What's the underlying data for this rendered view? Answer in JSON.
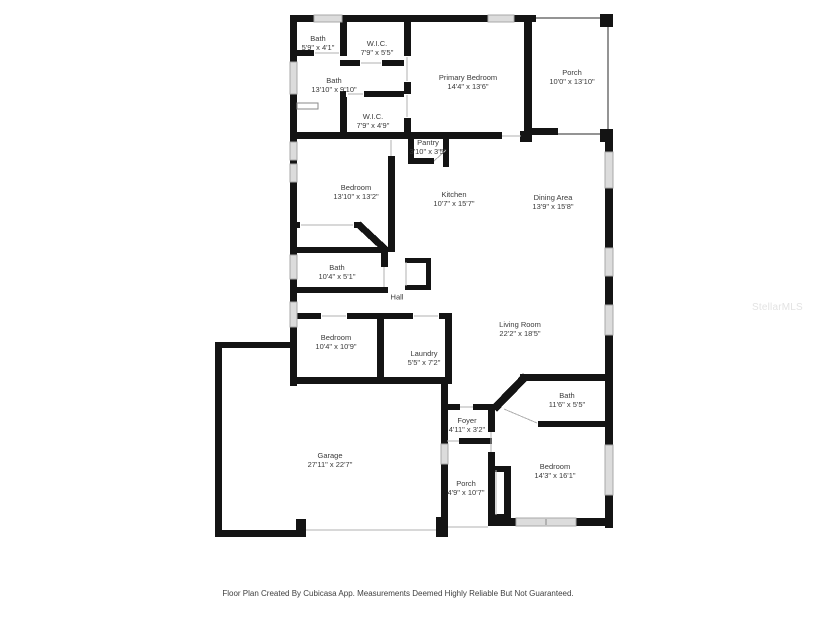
{
  "watermark": "StellarMLS",
  "footer": "Floor Plan Created By Cubicasa App. Measurements Deemed Highly Reliable But Not Guaranteed.",
  "rooms": [
    {
      "id": "bath-1",
      "name": "Bath",
      "dims": "5'9\" x 4'1\""
    },
    {
      "id": "wic-1",
      "name": "W.I.C.",
      "dims": "7'9\" x 5'5\""
    },
    {
      "id": "bath-2",
      "name": "Bath",
      "dims": "13'10\" x 9'10\""
    },
    {
      "id": "primary-bedroom",
      "name": "Primary Bedroom",
      "dims": "14'4\" x 13'6\""
    },
    {
      "id": "porch-top",
      "name": "Porch",
      "dims": "10'0\" x 13'10\""
    },
    {
      "id": "wic-2",
      "name": "W.I.C.",
      "dims": "7'9\" x 4'9\""
    },
    {
      "id": "pantry",
      "name": "Pantry",
      "dims": "3'10\" x 3'5\""
    },
    {
      "id": "bedroom-1",
      "name": "Bedroom",
      "dims": "13'10\" x 13'2\""
    },
    {
      "id": "kitchen",
      "name": "Kitchen",
      "dims": "10'7\" x 15'7\""
    },
    {
      "id": "dining-area",
      "name": "Dining Area",
      "dims": "13'9\" x 15'8\""
    },
    {
      "id": "bath-3",
      "name": "Bath",
      "dims": "10'4\" x 5'1\""
    },
    {
      "id": "hall",
      "name": "Hall",
      "dims": ""
    },
    {
      "id": "bedroom-2",
      "name": "Bedroom",
      "dims": "10'4\" x 10'9\""
    },
    {
      "id": "living-room",
      "name": "Living Room",
      "dims": "22'2\" x 18'5\""
    },
    {
      "id": "laundry",
      "name": "Laundry",
      "dims": "5'5\" x 7'2\""
    },
    {
      "id": "garage",
      "name": "Garage",
      "dims": "27'11\" x 22'7\""
    },
    {
      "id": "foyer",
      "name": "Foyer",
      "dims": "4'11\" x 3'2\""
    },
    {
      "id": "bath-4",
      "name": "Bath",
      "dims": "11'6\" x 5'5\""
    },
    {
      "id": "porch-bottom",
      "name": "Porch",
      "dims": "4'9\" x 10'7\""
    },
    {
      "id": "bedroom-3",
      "name": "Bedroom",
      "dims": "14'3\" x 16'1\""
    }
  ]
}
